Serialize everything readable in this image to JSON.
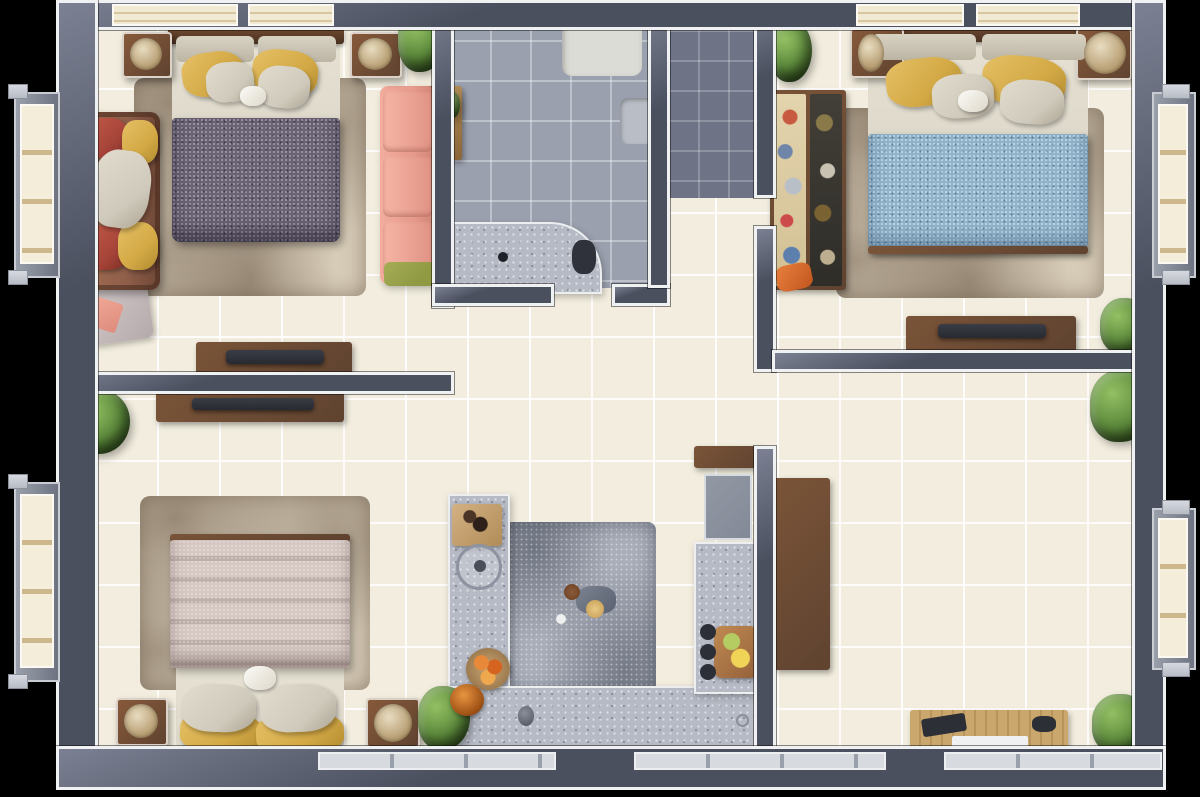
{
  "scene": {
    "type": "apartment-floor-plan",
    "view": "top-down-3d-render",
    "rooms_count": 7,
    "no_visible_text": true
  },
  "palette": {
    "outside": "#000000",
    "wall": "#4b505f",
    "wall_light": "#7b8092",
    "trim": "#f0f1f3",
    "floor_cream": "#f2edde",
    "floor_bath": "#9aa0ae",
    "floor_corridor": "#6e7386",
    "counter_marble": "#b6bac5",
    "rug_beige": "#d7ccb8",
    "rug_gray": "#a9aeb9",
    "duvet_purple": "#6a6275",
    "duvet_blue": "#8fb3cb",
    "duvet_stripe_a": "#d5c7c2",
    "duvet_stripe_b": "#bfafab",
    "mattress": "#ded9cb",
    "pillow_yellow": "#d3a945",
    "pillow_gray": "#d0cabc",
    "sofa_brown": "#91604b",
    "cushion_red": "#a8453a",
    "sofa_pink": "#e69a8b",
    "sofa_blue": "#93a9c7",
    "throw_green": "#8f9a43",
    "accent_red": "#c5243f",
    "wood_dark": "#5f4330",
    "wood_mid": "#7a5438",
    "wood_light": "#c9a76d",
    "tv_black": "#272a31",
    "chair_rose": "#c18a79",
    "table_slate": "#5a524f",
    "plant_green": "#5d8a3c",
    "stove_dark": "#32353d",
    "shelf_dark": "#3a3e48"
  },
  "rooms": [
    {
      "name": "bedroom-top-left",
      "furniture": [
        "double-bed",
        "purple-speckled-duvet",
        "yellow-pillows-2",
        "gray-pillows-2",
        "beige-area-rug",
        "brown-sofa-with-red-yellow-cushions",
        "pink-sectional-sofa",
        "nightstand-2",
        "decor-bowl-2",
        "tv-console",
        "tv",
        "corner-blanket",
        "potted-plant",
        "top-windows-2",
        "left-bay-window"
      ]
    },
    {
      "name": "bathroom",
      "furniture": [
        "bathtub",
        "toilet-2",
        "wall-sink",
        "counter-sink",
        "curved-vanity",
        "vanity-sink",
        "wood-tray-plants",
        "door-arc"
      ]
    },
    {
      "name": "entry-corridor",
      "furniture": [
        "dark-tile-floor",
        "entry-door-arc",
        "silver-threshold"
      ]
    },
    {
      "name": "bedroom-top-right",
      "furniture": [
        "double-bed",
        "blue-speckled-duvet",
        "yellow-pillows-2",
        "gray-pillows-2",
        "beige-area-rug",
        "open-wardrobe-colorful",
        "nightstand-2",
        "basket",
        "tv-console",
        "tv",
        "potted-plant-3",
        "top-windows-2",
        "right-bay-window"
      ]
    },
    {
      "name": "bedroom-bottom-left",
      "furniture": [
        "double-bed-foot-up",
        "striped-pink-duvet",
        "yellow-pillows-2",
        "gray-pillows-2",
        "beige-area-rug",
        "nightstand-2",
        "tv-console",
        "tv",
        "potted-plant-2",
        "wall-shelves-dark-2",
        "left-bay-window"
      ]
    },
    {
      "name": "kitchen-living",
      "furniture": [
        "blue-two-seat-sofa",
        "gray-rug",
        "round-wood-coffee-table",
        "u-shaped-marble-counter",
        "cooktop-4-burners",
        "refrigerator",
        "counter-sink",
        "red-towel",
        "cutting-board",
        "fruit-bowl",
        "jar",
        "wood-serving-tray",
        "jars-3"
      ]
    },
    {
      "name": "dining-room",
      "furniture": [
        "rectangular-dining-table",
        "rose-chairs-8",
        "plates-3",
        "sideboard-with-runner",
        "white-triangle-decor-2",
        "console-table",
        "tray-items",
        "potted-plant-2",
        "door-arc",
        "right-bay-window",
        "bottom-windows"
      ]
    }
  ]
}
